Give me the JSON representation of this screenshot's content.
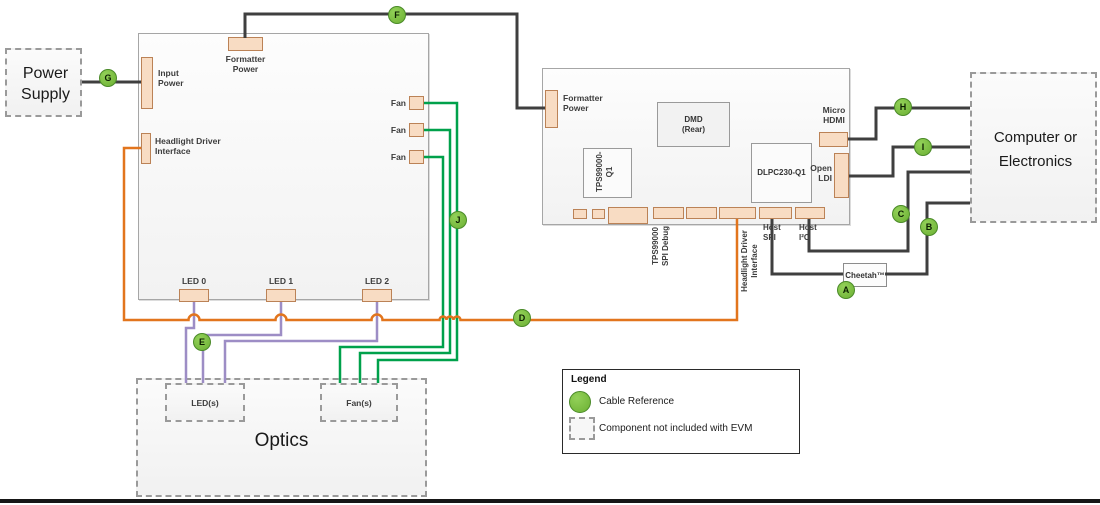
{
  "colors": {
    "wire_dark": "#3F3F3F",
    "wire_green": "#00A14B",
    "wire_orange": "#E2751D",
    "wire_purple": "#9D8DC5",
    "connector_fill": "#F8DCC3",
    "connector_border": "#BB8256",
    "cable_ref_green": "#7CC142"
  },
  "power_supply": {
    "label": "Power Supply"
  },
  "left_board": {
    "formatter_power": "Formatter Power",
    "input_power": "Input Power",
    "headlight_driver_interface": "Headlight Driver Interface",
    "fan_labels": [
      "Fan",
      "Fan",
      "Fan"
    ],
    "led_labels": [
      "LED 0",
      "LED 1",
      "LED 2"
    ]
  },
  "right_board": {
    "formatter_power": "Formatter Power",
    "dmd": "DMD (Rear)",
    "tps99000": "TPS99000-Q1",
    "dlpc230": "DLPC230-Q1",
    "micro_hdmi": "Micro HDMI",
    "open_ldi": "Open LDI",
    "tps_debug_lines": [
      "TPS99000",
      "SPI Debug"
    ],
    "hdi_lines": [
      "Headlight Driver",
      "Interface"
    ],
    "host_spi": "Host SPI",
    "host_i2c": "Host I²C"
  },
  "cheetah": {
    "label": "Cheetah™"
  },
  "computer": {
    "label": "Computer or Electronics"
  },
  "optics": {
    "label": "Optics",
    "leds": "LED(s)",
    "fans": "Fan(s)"
  },
  "legend": {
    "title": "Legend",
    "cable_reference": "Cable Reference",
    "component_note": "Component not included with EVM"
  },
  "cable_refs": {
    "a": "A",
    "b": "B",
    "c": "C",
    "d": "D",
    "e": "E",
    "f": "F",
    "g": "G",
    "h": "H",
    "i": "I",
    "j": "J"
  }
}
